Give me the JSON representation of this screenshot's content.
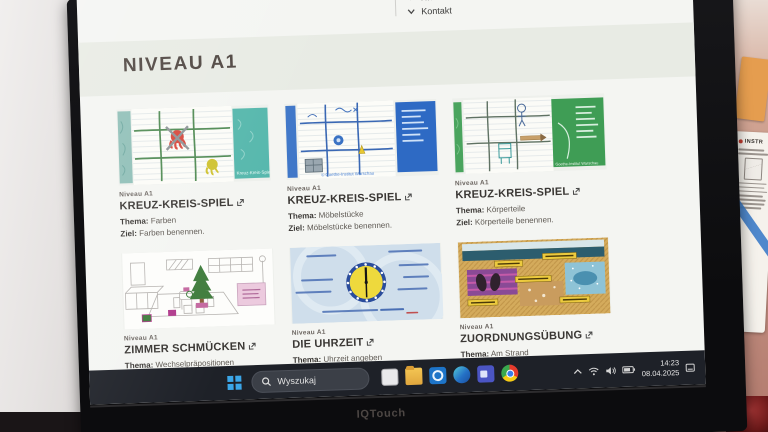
{
  "monitor": {
    "brand": "IQTouch"
  },
  "screen_page": {
    "menu": [
      {
        "label": "Niveau A2"
      },
      {
        "label": "Kontakt"
      }
    ],
    "heading": "NIVEAU A1",
    "labels": {
      "thema": "Thema:",
      "ziel": "Ziel:"
    },
    "cards": [
      {
        "level": "Niveau A1",
        "title": "KREUZ-KREIS-SPIEL",
        "thema": "Farben",
        "ziel": "Farben benennen.",
        "image_caption": "Kreuz-Kreis-Spiel"
      },
      {
        "level": "Niveau A1",
        "title": "KREUZ-KREIS-SPIEL",
        "thema": "Möbelstücke",
        "ziel": "Möbelstücke benennen.",
        "image_caption": "© Goethe-Institut Warschau"
      },
      {
        "level": "Niveau A1",
        "title": "KREUZ-KREIS-SPIEL",
        "thema": "Körperteile",
        "ziel": "Körperteile benennen.",
        "image_caption": "Goethe-Institut Warschau"
      },
      {
        "level": "Niveau A1",
        "title": "ZIMMER SCHMÜCKEN",
        "thema": "Wechselpräpositionen"
      },
      {
        "level": "Niveau A1",
        "title": "DIE UHRZEIT",
        "thema": "Uhrzeit angeben"
      },
      {
        "level": "Niveau A1",
        "title": "ZUORDNUNGSÜBUNG",
        "thema": "Am Strand"
      }
    ]
  },
  "taskbar": {
    "search_placeholder": "Wyszukaj",
    "clock": {
      "time": "14:23",
      "date": "08.04.2025"
    }
  },
  "wall": {
    "poster_title": "INSTR"
  }
}
